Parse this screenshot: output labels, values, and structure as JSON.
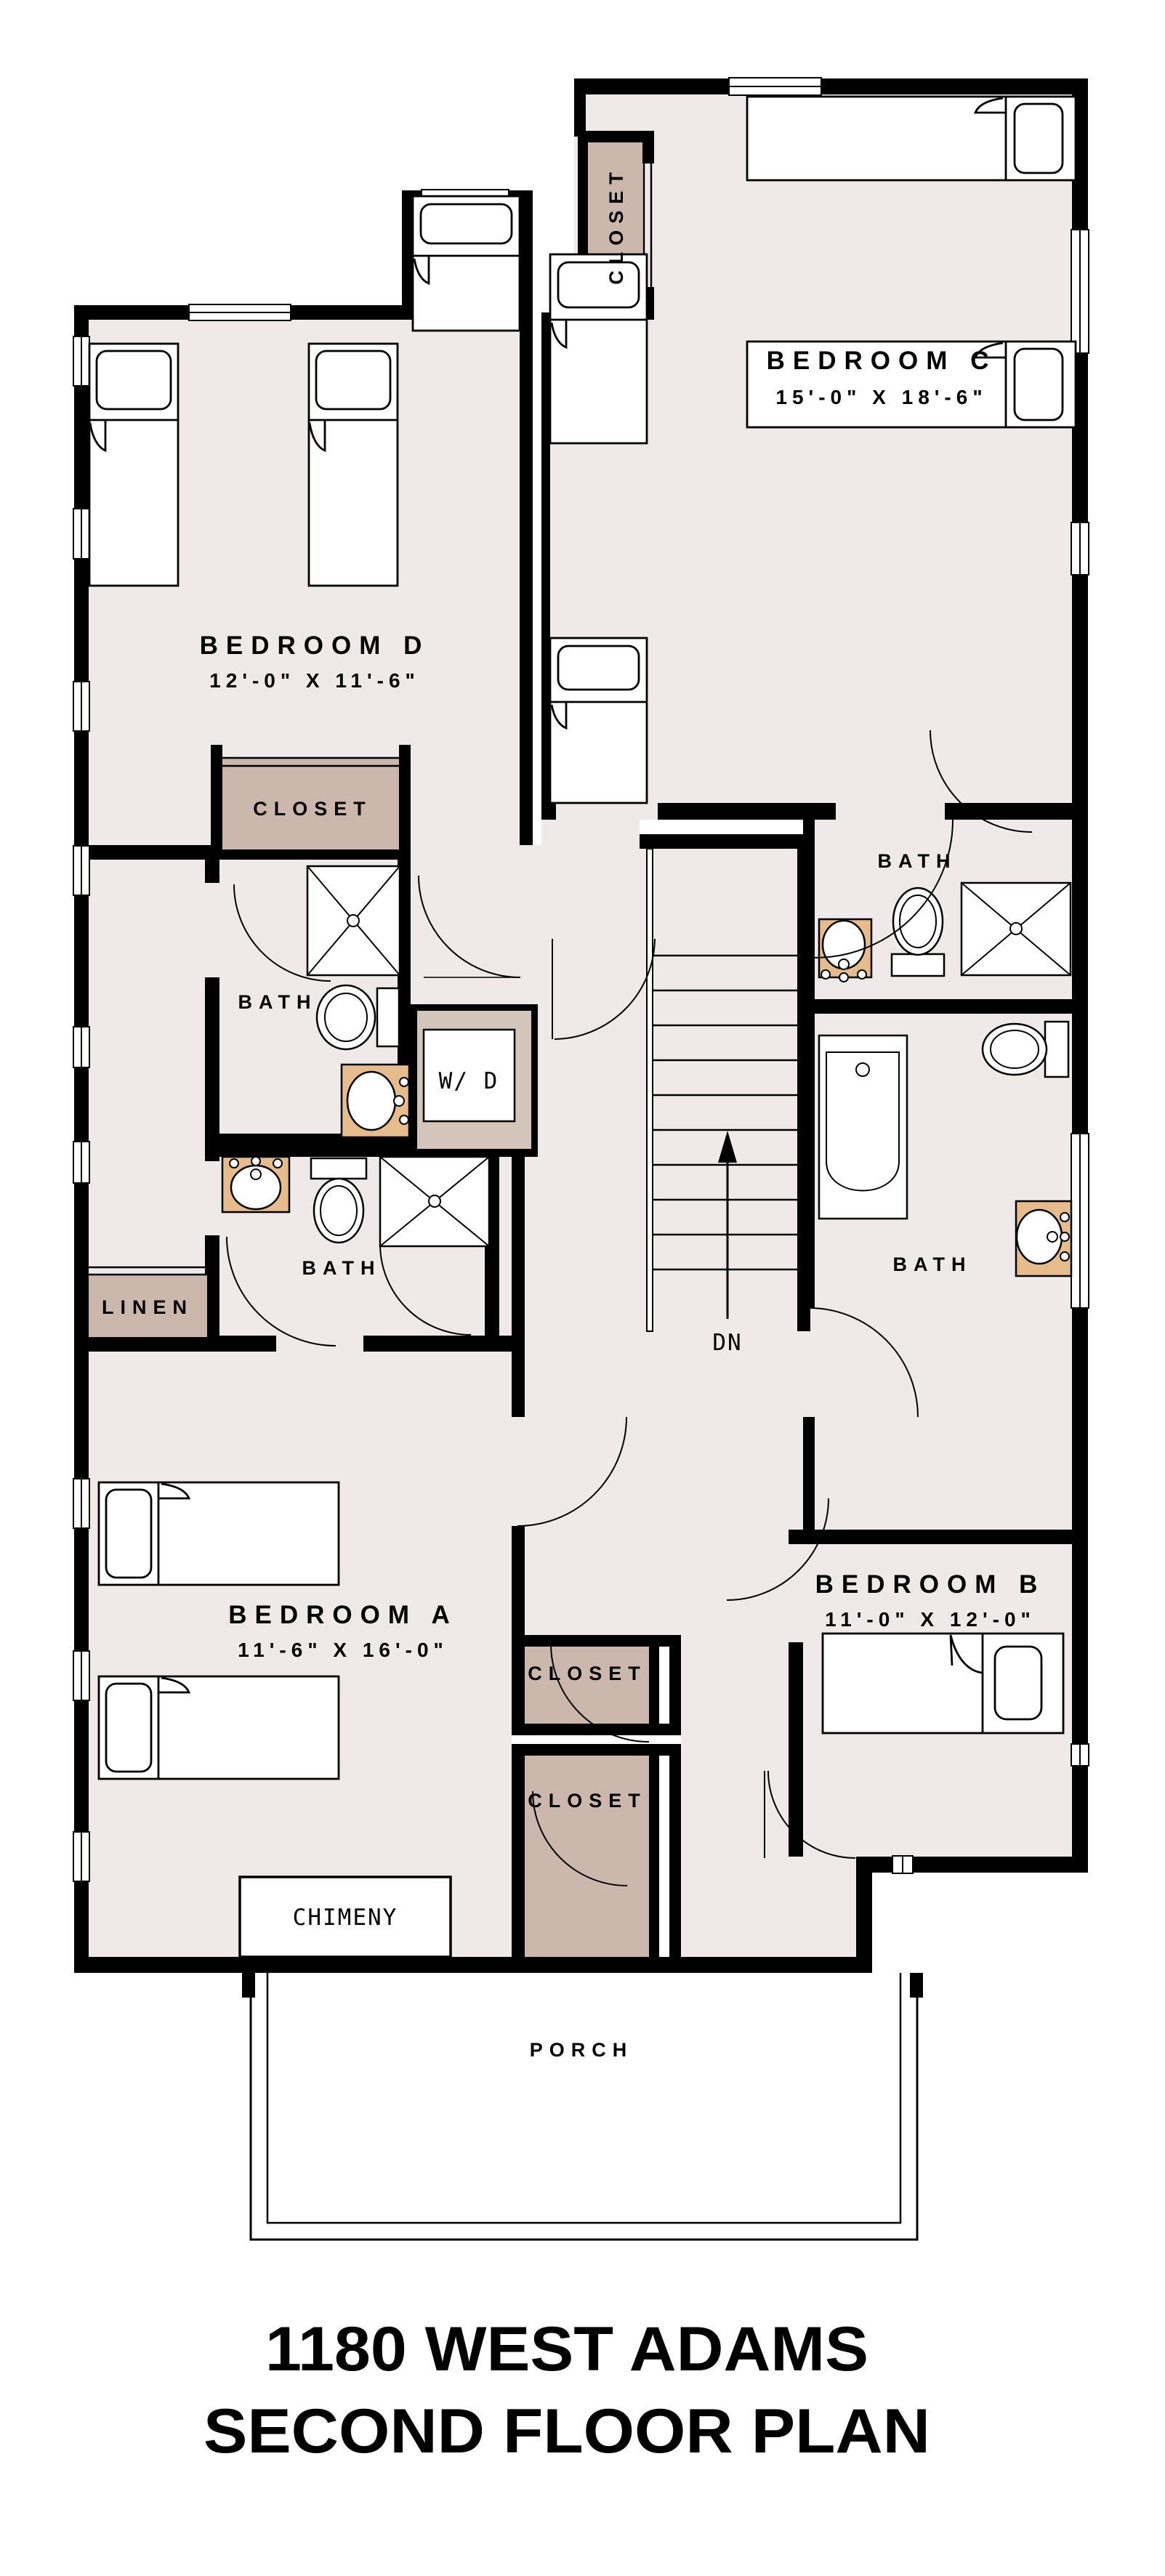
{
  "title": {
    "line1": "1180 WEST ADAMS",
    "line2": "SECOND FLOOR PLAN"
  },
  "rooms": {
    "bedroom_c": {
      "name": "BEDROOM C",
      "dims": "15'-0\" X 18'-6\""
    },
    "bedroom_d": {
      "name": "BEDROOM D",
      "dims": "12'-0\" X 11'-6\""
    },
    "bedroom_a": {
      "name": "BEDROOM A",
      "dims": "11'-6\" X 16'-0\""
    },
    "bedroom_b": {
      "name": "BEDROOM B",
      "dims": "11'-0\" X 12'-0\""
    },
    "bath_upper_left": {
      "name": "BATH"
    },
    "bath_lower_left": {
      "name": "BATH"
    },
    "bath_upper_right": {
      "name": "BATH"
    },
    "bath_lower_right": {
      "name": "BATH"
    },
    "closet_top": {
      "name": "CLOSET"
    },
    "closet_bedroom_d": {
      "name": "CLOSET"
    },
    "closet_mid_upper": {
      "name": "CLOSET"
    },
    "closet_mid_lower": {
      "name": "CLOSET"
    },
    "linen": {
      "name": "LINEN"
    },
    "laundry": {
      "name": "W/ D"
    },
    "chimney": {
      "name": "CHIMENY"
    },
    "porch": {
      "name": "PORCH"
    },
    "stairs": {
      "direction_label": "DN"
    }
  },
  "colors": {
    "room_fill": "#F0E9EA",
    "closet_fill": "#CBB7AB",
    "counter_fill": "#E7BC8C",
    "laundry_fill": "#D3C5BA",
    "wall": "#000000",
    "background": "#FFFFFF"
  }
}
